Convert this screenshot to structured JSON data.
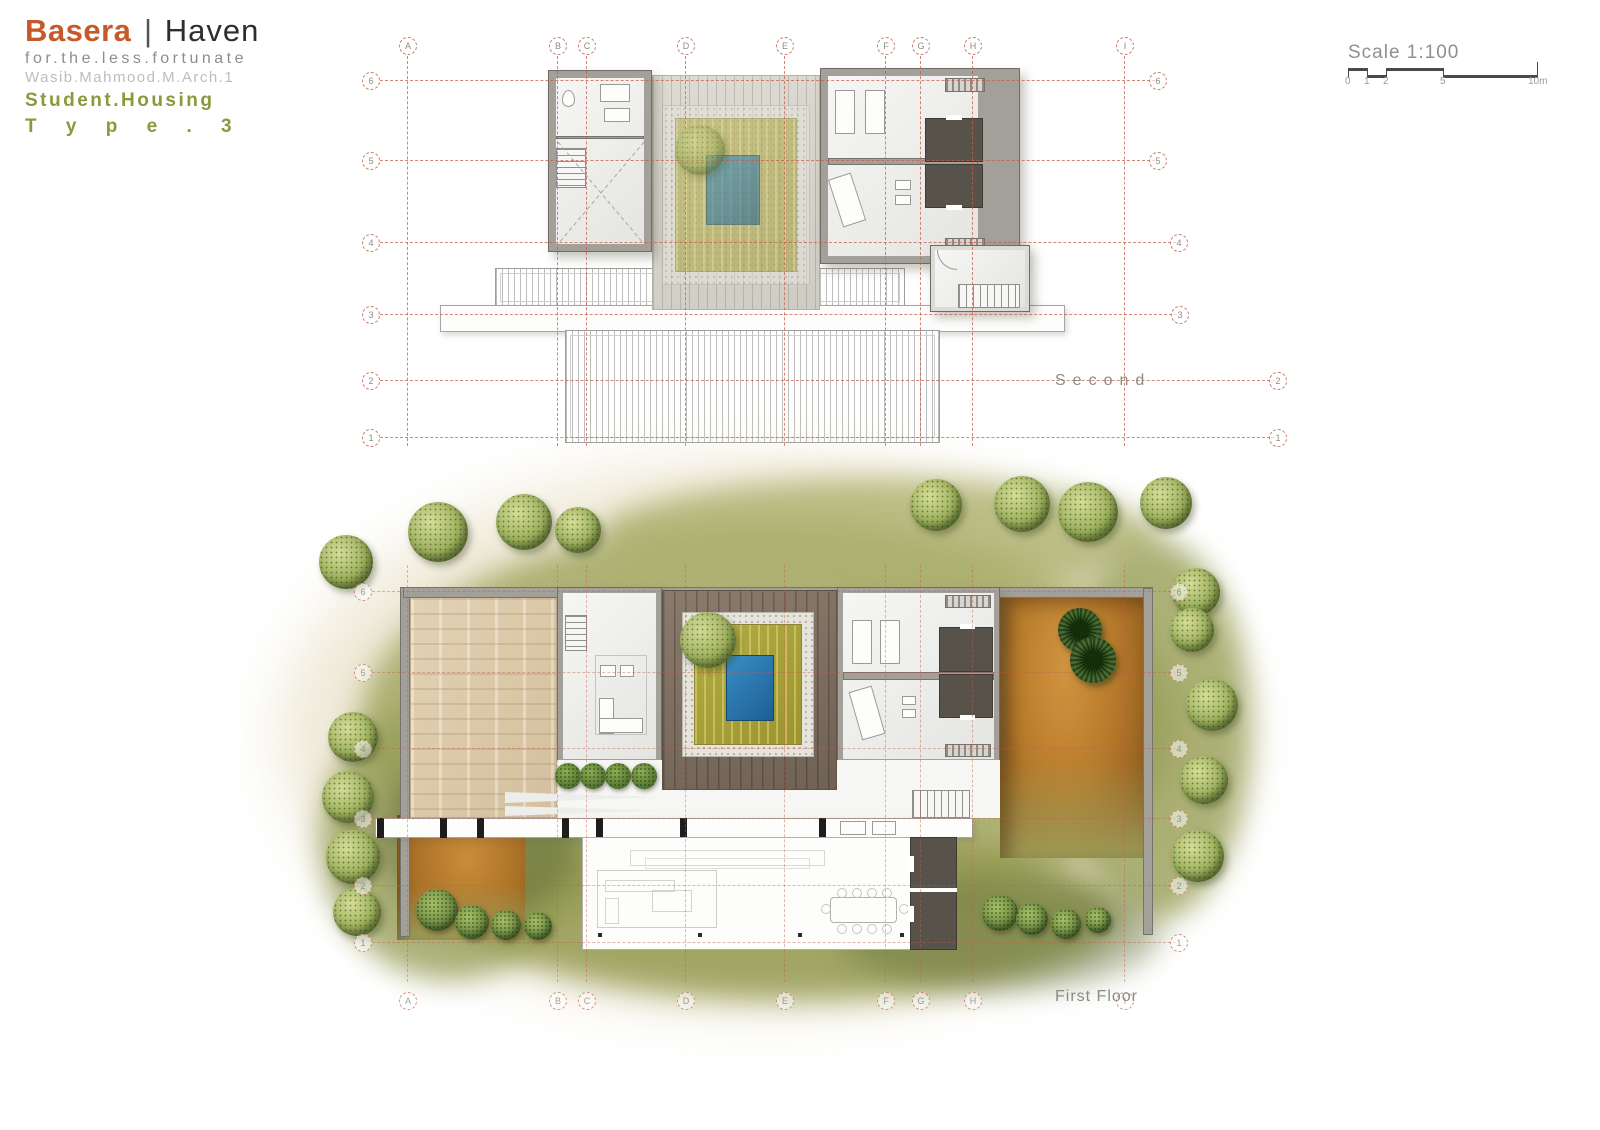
{
  "title": {
    "brand": "Basera",
    "divider": "|",
    "name": "Haven",
    "tagline": "for.the.less.fortunate",
    "author": "Wasib.Mahmood.M.Arch.1",
    "program": "Student.Housing",
    "type": "T y p e . 3"
  },
  "scale": {
    "label": "Scale 1:100",
    "ticks": [
      {
        "label": "0",
        "m": 0
      },
      {
        "label": "1",
        "m": 1
      },
      {
        "label": "2",
        "m": 2
      },
      {
        "label": "5",
        "m": 5
      },
      {
        "label": "10m",
        "m": 10
      }
    ]
  },
  "plans": {
    "second": {
      "label": "Second"
    },
    "first": {
      "label": "First Floor"
    }
  },
  "grid": {
    "columns": [
      {
        "label": "A",
        "x": 407
      },
      {
        "label": "B",
        "x": 557
      },
      {
        "label": "C",
        "x": 586
      },
      {
        "label": "D",
        "x": 685
      },
      {
        "label": "E",
        "x": 784
      },
      {
        "label": "F",
        "x": 885
      },
      {
        "label": "G",
        "x": 920
      },
      {
        "label": "H",
        "x": 972
      },
      {
        "label": "I",
        "x": 1124
      }
    ],
    "rows": [
      {
        "label": "6",
        "second": 80,
        "first": 591
      },
      {
        "label": "5",
        "second": 160,
        "first": 672
      },
      {
        "label": "4",
        "second": 242,
        "first": 748
      },
      {
        "label": "3",
        "second": 314,
        "first": 818
      },
      {
        "label": "2",
        "second": 380,
        "first": 885
      },
      {
        "label": "1",
        "second": 437,
        "first": 942
      }
    ],
    "plans": [
      {
        "id": "second",
        "left": 360,
        "top": 30,
        "row_key": "second",
        "letters": "top",
        "letters_y": 15,
        "line_y1": 26,
        "line_y2": 416,
        "line_x1": 20,
        "circle_left_x": 10,
        "right_x": [
          797,
          797,
          818,
          819,
          917,
          917
        ]
      },
      {
        "id": "first",
        "left": 300,
        "top": 460,
        "row_key": "first",
        "letters": "bottom",
        "letters_y": 540,
        "line_y1": 105,
        "line_y2": 522,
        "line_x1": 72,
        "circle_left_x": 62,
        "right_x": [
          878,
          878,
          878,
          878,
          878,
          878
        ]
      }
    ]
  },
  "landscape": {
    "trees": [
      {
        "t": "tree",
        "x": 46,
        "y": 102,
        "r": 27
      },
      {
        "t": "tree",
        "x": 138,
        "y": 72,
        "r": 30
      },
      {
        "t": "tree",
        "x": 224,
        "y": 62,
        "r": 28
      },
      {
        "t": "tree",
        "x": 278,
        "y": 70,
        "r": 23
      },
      {
        "t": "tree",
        "x": 636,
        "y": 45,
        "r": 26
      },
      {
        "t": "tree",
        "x": 722,
        "y": 44,
        "r": 28
      },
      {
        "t": "tree",
        "x": 788,
        "y": 52,
        "r": 30
      },
      {
        "t": "tree",
        "x": 866,
        "y": 43,
        "r": 26
      },
      {
        "t": "tree",
        "x": 896,
        "y": 132,
        "r": 24
      },
      {
        "t": "tree",
        "x": 892,
        "y": 170,
        "r": 22
      },
      {
        "t": "tree",
        "x": 912,
        "y": 245,
        "r": 26
      },
      {
        "t": "tree",
        "x": 904,
        "y": 320,
        "r": 24
      },
      {
        "t": "tree",
        "x": 898,
        "y": 396,
        "r": 26
      },
      {
        "t": "tree",
        "x": 53,
        "y": 277,
        "r": 25
      },
      {
        "t": "tree",
        "x": 48,
        "y": 337,
        "r": 26
      },
      {
        "t": "tree",
        "x": 53,
        "y": 397,
        "r": 27
      },
      {
        "t": "tree",
        "x": 57,
        "y": 452,
        "r": 24
      },
      {
        "t": "bush",
        "x": 137,
        "y": 450,
        "r": 21
      },
      {
        "t": "bush",
        "x": 172,
        "y": 462,
        "r": 17
      },
      {
        "t": "bush",
        "x": 206,
        "y": 465,
        "r": 15
      },
      {
        "t": "bush",
        "x": 238,
        "y": 466,
        "r": 14
      },
      {
        "t": "bush",
        "x": 700,
        "y": 453,
        "r": 18
      },
      {
        "t": "bush",
        "x": 732,
        "y": 459,
        "r": 16
      },
      {
        "t": "bush",
        "x": 766,
        "y": 464,
        "r": 15
      },
      {
        "t": "bush",
        "x": 798,
        "y": 460,
        "r": 13
      },
      {
        "t": "hedge",
        "x": 268,
        "y": 316,
        "r": 13
      },
      {
        "t": "hedge",
        "x": 293,
        "y": 316,
        "r": 13
      },
      {
        "t": "hedge",
        "x": 318,
        "y": 316,
        "r": 13
      },
      {
        "t": "hedge",
        "x": 344,
        "y": 316,
        "r": 13
      },
      {
        "t": "palm",
        "x": 780,
        "y": 170,
        "r": 22
      },
      {
        "t": "palm",
        "x": 793,
        "y": 200,
        "r": 23
      }
    ]
  },
  "colors": {
    "brand_orange": "#c7582a",
    "olive_green": "#8a9a3b",
    "grid_red": "#c65c4c",
    "wall_gray": "#a3a099",
    "pool_blue": "#2476ae",
    "courtyard_grass": "#a8a33b",
    "landscape_green": "#a3a963",
    "terracotta": "#b5792a",
    "dark_room": "#57524a"
  }
}
